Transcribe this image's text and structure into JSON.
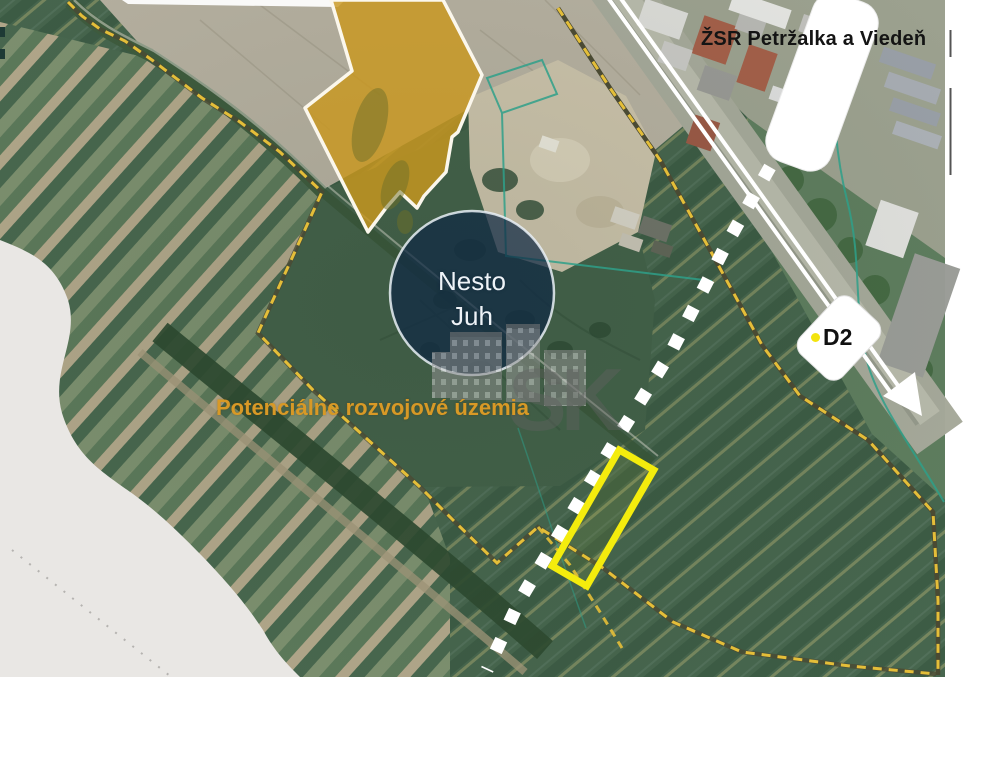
{
  "map": {
    "annotations": {
      "railway_label": "ŽSR Petržalka a Viedeň",
      "site_name_line1": "Nesto",
      "site_name_line2": "Juh",
      "highway_sign": "D2",
      "development_label": "Potenciálne rozvojové územia",
      "watermark": "SK"
    },
    "colors": {
      "development_boundary_dash": "#E4BE39",
      "boundary_casing": "#4A4A33",
      "parcel_highlight": "#F4EC0D",
      "planned_road_dash": "#FFFFFF",
      "site_circle_fill": "#0F2844",
      "site_circle_stroke": "#E9F0F6",
      "development_label_text": "#D89926",
      "cadastral_line": "#2FA08A",
      "highway_sign_dot": "#F3E40F",
      "gold_area_fill": "#C9971F",
      "gold_area_border": "#FBF7EC"
    }
  }
}
